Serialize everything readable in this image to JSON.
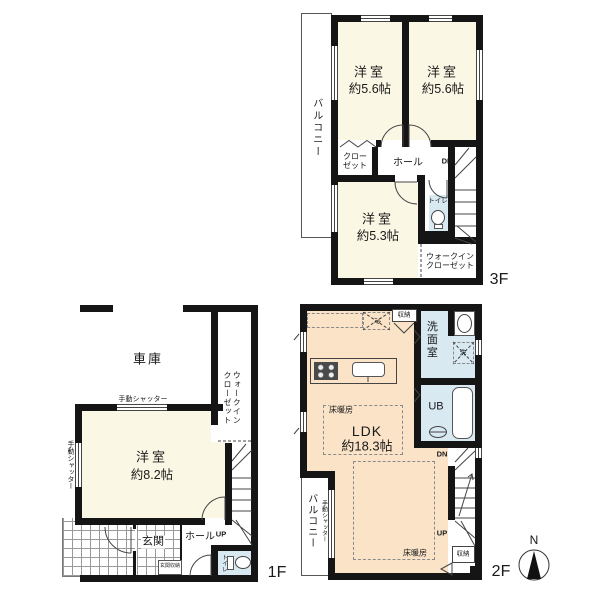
{
  "colors": {
    "wall": "#151515",
    "room_cream": "#faf7e4",
    "room_peach": "#fae3c7",
    "wet_blue": "#d8e9f2",
    "line": "#444444"
  },
  "f3": {
    "floor_label": "3F",
    "balcony": "バルコニー",
    "room1_name": "洋室",
    "room1_size": "約5.6帖",
    "room2_name": "洋室",
    "room2_size": "約5.6帖",
    "closet": "クロー\nゼット",
    "hall": "ホール",
    "dn": "DN",
    "toilet": "トイレ",
    "room3_name": "洋室",
    "room3_size": "約5.3帖",
    "wic": "ウォークイン\nクローゼット"
  },
  "f1": {
    "floor_label": "1F",
    "garage": "車庫",
    "wic": "ウォークイン\nクローゼット",
    "shutter_top": "手動シャッター",
    "shutter_left": "手動シャッター",
    "room_name": "洋室",
    "room_size": "約8.2帖",
    "entrance": "玄関",
    "entrance_storage": "玄関収納",
    "hall": "ホール",
    "up": "UP",
    "toilet": "トイレ"
  },
  "f2": {
    "floor_label": "2F",
    "ldk_name": "LDK",
    "ldk_size": "約18.3帖",
    "floor_heating1": "床暖房",
    "floor_heating2": "床暖房",
    "fridge": "冷",
    "storage_top": "収納",
    "storage_bottom": "収納",
    "washroom": "洗面室",
    "washer": "洗",
    "ub": "UB",
    "dn": "DN",
    "up": "UP",
    "balcony": "バルコニー",
    "shutter": "手動シャッター"
  },
  "compass": {
    "north": "N"
  }
}
